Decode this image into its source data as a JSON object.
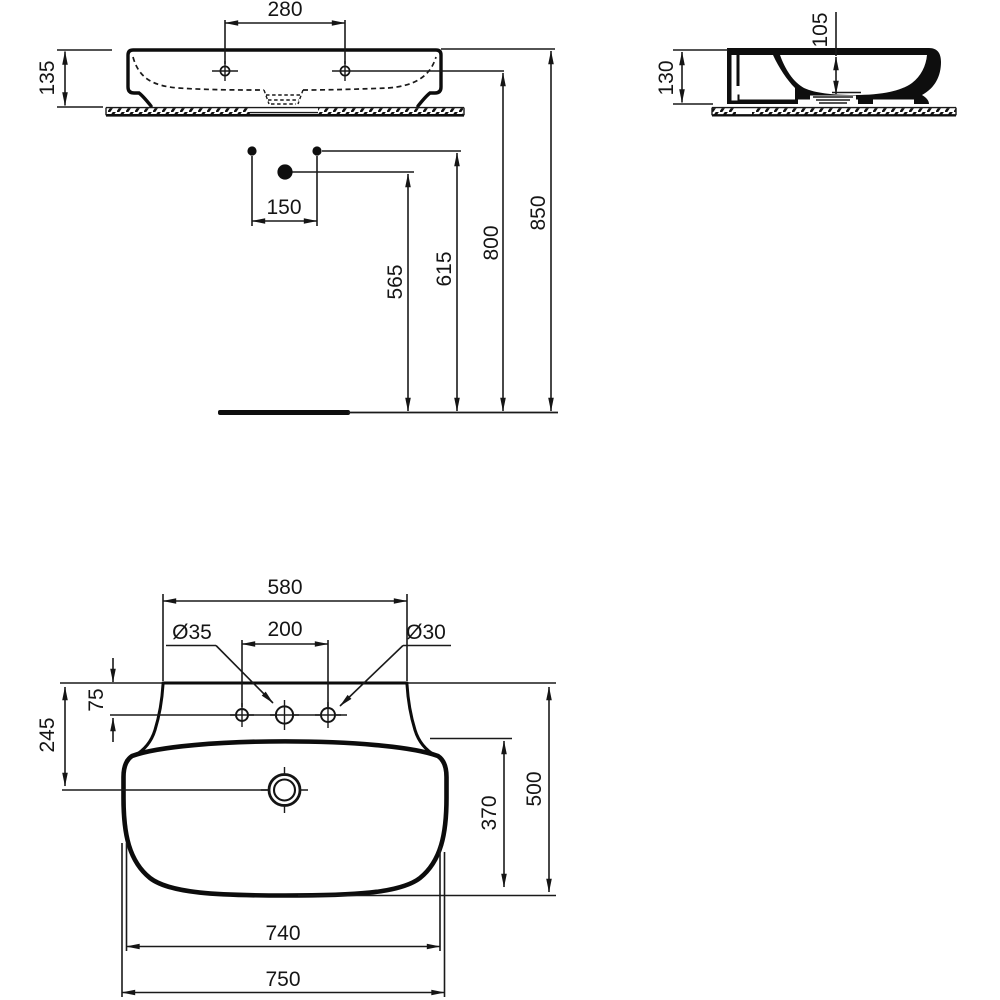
{
  "front_view": {
    "tap_hole_spacing": "280",
    "basin_height": "135",
    "supply_spacing": "150",
    "drain_height": "565",
    "supply_height": "615",
    "tap_hole_height": "800",
    "rim_height": "850"
  },
  "side_view": {
    "basin_height": "130",
    "bowl_depth": "105"
  },
  "plan_view": {
    "back_edge_width": "580",
    "center_hole_diameter": "Ø35",
    "outer_hole_spacing": "200",
    "right_hole_diameter": "Ø30",
    "hole_offset": "75",
    "drain_offset": "245",
    "bowl_inner_depth": "370",
    "overall_depth": "500",
    "bowl_width": "740",
    "overall_width": "750"
  }
}
